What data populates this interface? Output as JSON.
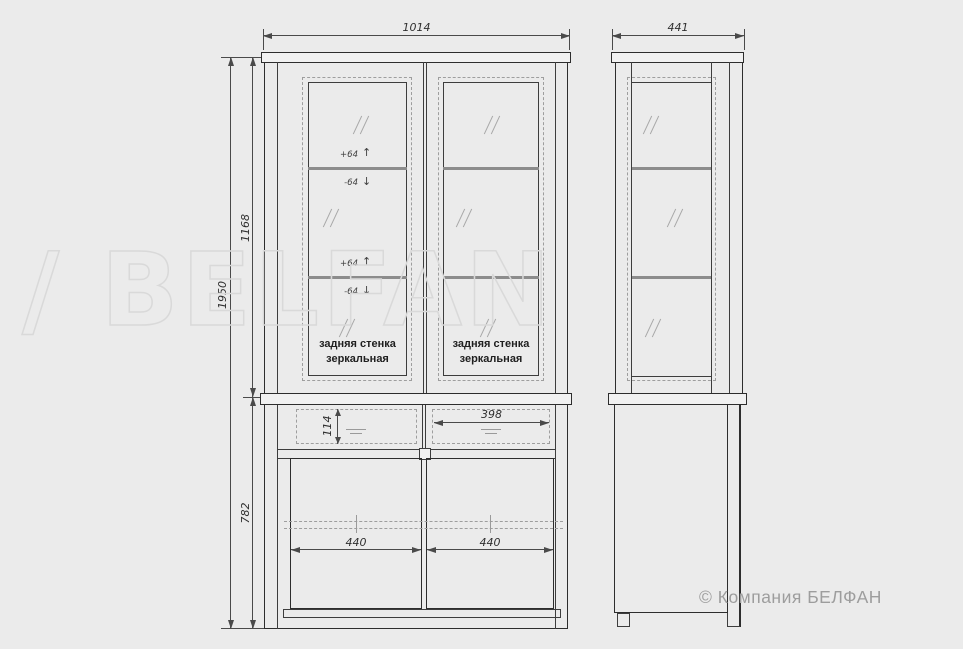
{
  "views": {
    "front": {
      "dims": {
        "width": "1014",
        "total_height": "1950",
        "upper_height": "1168",
        "lower_height": "782",
        "drawer_inner_height": "114",
        "drawer_inner_width": "398",
        "door_widths": [
          "440",
          "440"
        ]
      },
      "shelf_adjust": {
        "up_label": "+64",
        "down_label": "-64"
      },
      "icons": {
        "up_arrow": "↑",
        "down_arrow": "↓"
      },
      "back_panel_note": {
        "line1": "задняя стенка",
        "line2": "зеркальная"
      }
    },
    "side": {
      "dims": {
        "depth": "441"
      }
    }
  },
  "watermark": {
    "text": "/ BELFAN"
  },
  "footer": {
    "copyright": "© Компания БЕЛФАН"
  },
  "colors": {
    "ink": "#2d2d2d",
    "dash": "#9e9e9e",
    "shelf": "#8c8c8c",
    "wm": "#d9d9d9",
    "copy": "#9d9d9d",
    "bg": "#ebebeb"
  }
}
